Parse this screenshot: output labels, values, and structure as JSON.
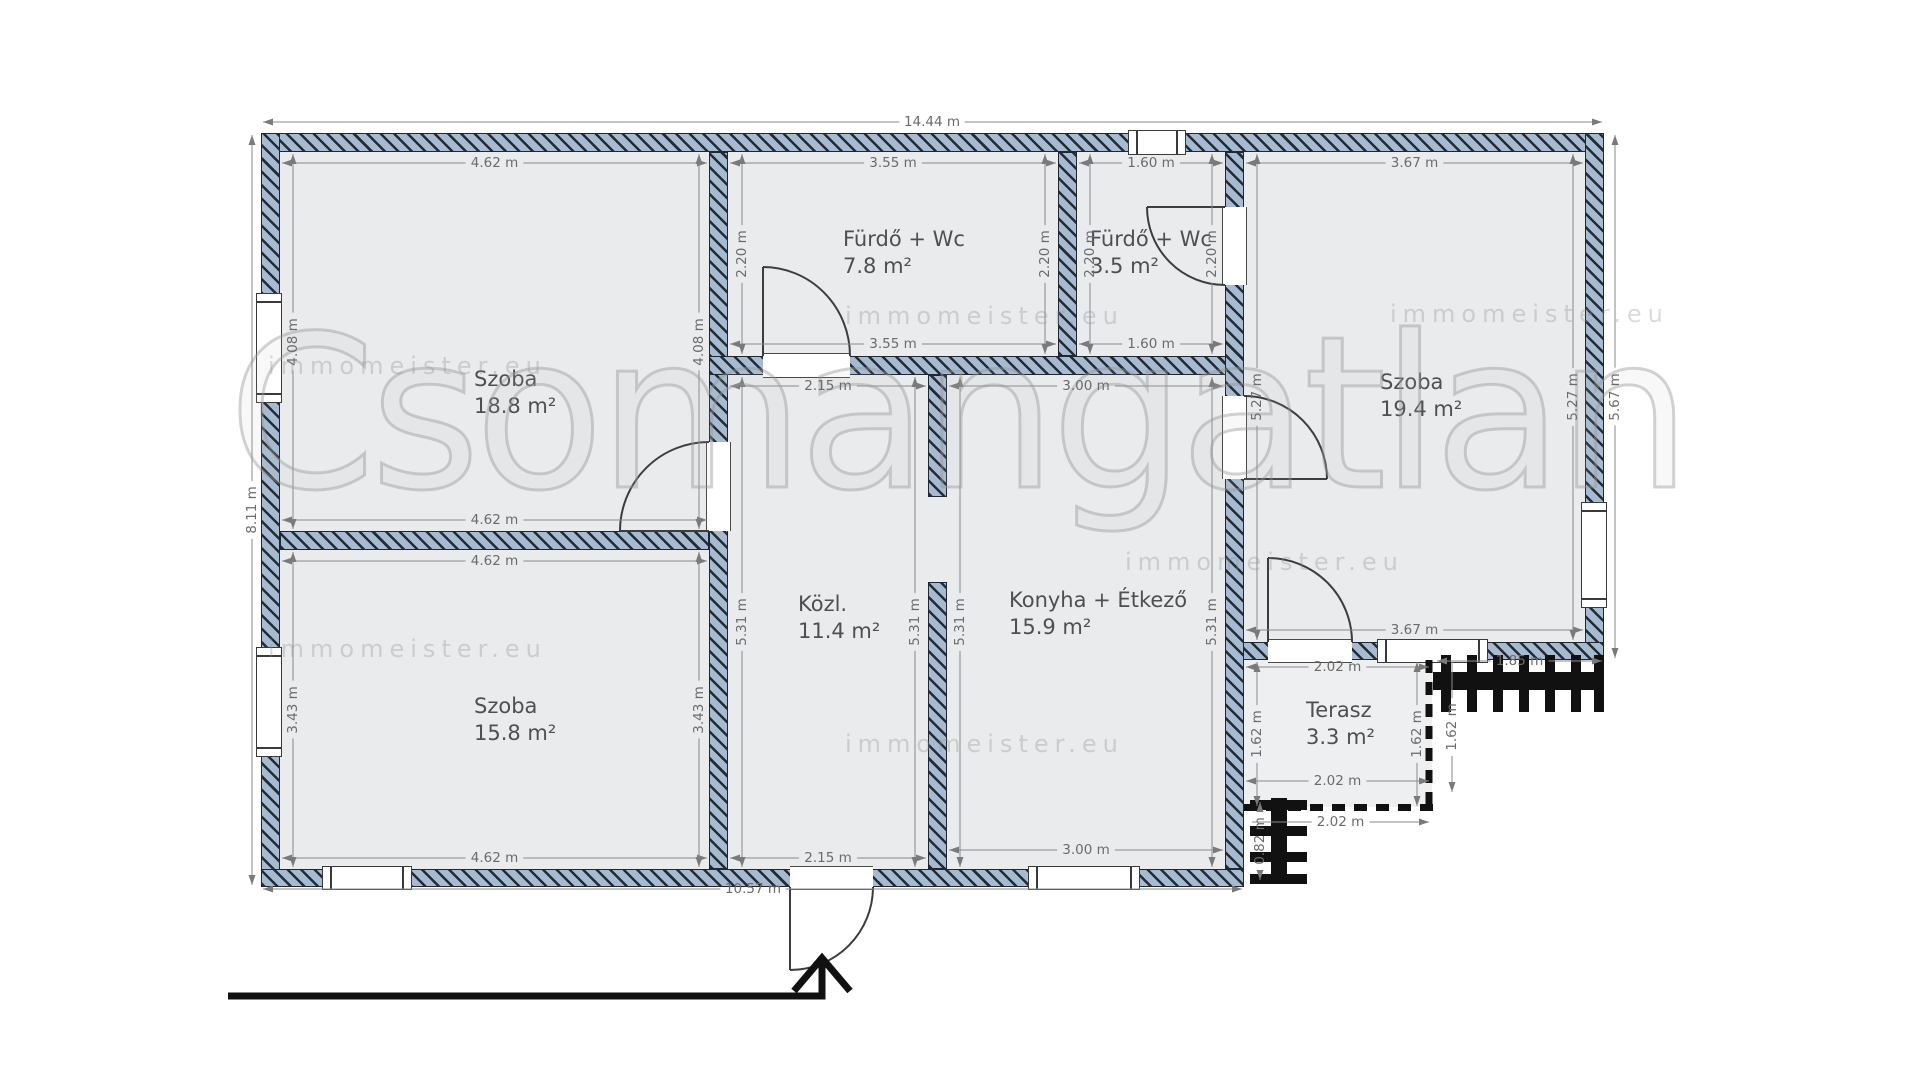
{
  "watermark": {
    "brand": "Csomangatlan",
    "tile": "immomeister.eu"
  },
  "rooms": {
    "szoba1": {
      "name": "Szoba",
      "area": "18.8 m²"
    },
    "furdo1": {
      "name": "Fürdő + Wc",
      "area": "7.8 m²"
    },
    "furdo2": {
      "name": "Fürdő + Wc",
      "area": "3.5 m²"
    },
    "szoba2": {
      "name": "Szoba",
      "area": "15.8 m²"
    },
    "kozl": {
      "name": "Közl.",
      "area": "11.4 m²"
    },
    "konyha": {
      "name": "Konyha + Étkező",
      "area": "15.9 m²"
    },
    "szoba3": {
      "name": "Szoba",
      "area": "19.4 m²"
    },
    "terasz": {
      "name": "Terasz",
      "area": "3.3 m²"
    }
  },
  "dimensions": {
    "overall_top": "14.44 m",
    "left_total": "8.11 m",
    "bottom_left_total": "10.57 m",
    "right_total": "5.67 m",
    "szoba1_width_top": "4.62 m",
    "szoba1_width_bottom": "4.62 m",
    "szoba1_height_left": "4.08 m",
    "szoba1_height_right": "4.08 m",
    "szoba2_width_top": "4.62 m",
    "szoba2_width_bottom": "4.62 m",
    "szoba2_height_left": "3.43 m",
    "szoba2_height_right": "3.43 m",
    "furdo1_width_top": "3.55 m",
    "furdo1_width_bottom": "3.55 m",
    "furdo1_height_left": "2.20 m",
    "furdo1_height_right": "2.20 m",
    "furdo2_width_top": "1.60 m",
    "furdo2_width_bottom": "1.60 m",
    "furdo2_height_left": "2.20 m",
    "furdo2_height_right": "2.20 m",
    "kozl_width_top": "2.15 m",
    "kozl_width_bottom": "2.15 m",
    "kozl_height_left": "5.31 m",
    "kozl_height_right": "5.31 m",
    "konyha_width_top": "3.00 m",
    "konyha_width_bottom": "3.00 m",
    "konyha_height_left": "5.31 m",
    "konyha_height_right": "5.31 m",
    "szoba3_width_top": "3.67 m",
    "szoba3_width_bottom": "3.67 m",
    "szoba3_height_left": "5.27 m",
    "szoba3_height_right": "5.27 m",
    "terasz_width_top": "2.02 m",
    "terasz_width_bottom": "2.02 m",
    "terasz_width_outside": "2.02 m",
    "terasz_height_left": "1.62 m",
    "terasz_height_right": "1.62 m",
    "stairs_right_width": "1.85 m",
    "stairs_right_height": "1.62 m",
    "stairs_bottom_height": "0.82 m"
  }
}
